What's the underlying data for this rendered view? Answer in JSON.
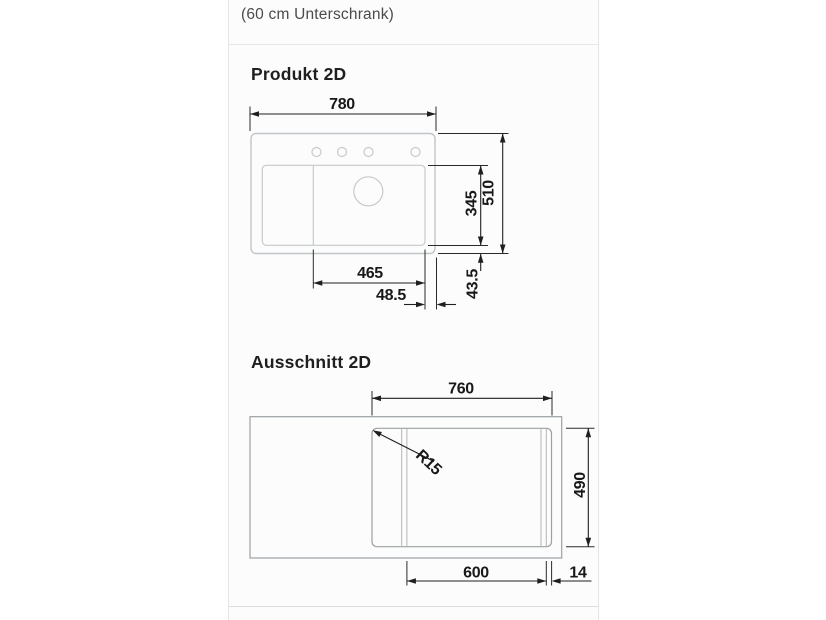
{
  "page": {
    "subtitle": "(60 cm Unterschrank)"
  },
  "produkt": {
    "heading": "Produkt 2D",
    "dims": {
      "total_width": "780",
      "total_depth": "510",
      "bowl_depth": "345",
      "bowl_width": "465",
      "bowl_right_offset": "48.5",
      "bowl_bottom_offset": "43.5"
    }
  },
  "ausschnitt": {
    "heading": "Ausschnitt 2D",
    "dims": {
      "cutout_width": "760",
      "cutout_depth": "490",
      "corner_radius": "R15",
      "rail_span": "600",
      "rail_edge_offset": "14"
    }
  },
  "colors": {
    "dimension_ink": "#1f1f1f",
    "product_outline": "#c0c5c7",
    "cutout_outline": "#9ba1a4",
    "panel_border": "#e5e5e3",
    "panel_bg": "#fcfcfc"
  }
}
